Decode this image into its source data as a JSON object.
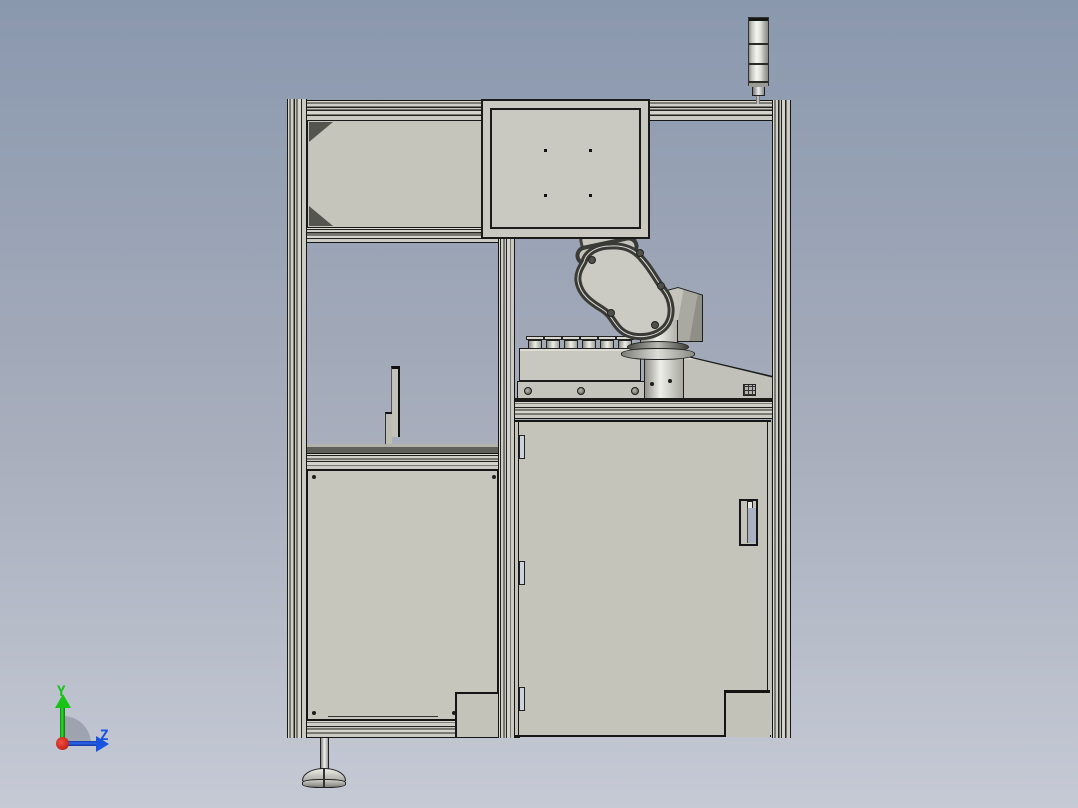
{
  "viewport": {
    "type": "3d-cad-viewport",
    "background_top": "#8a98ae",
    "background_bottom": "#c5cad5"
  },
  "triad": {
    "y_label": "Y",
    "z_label": "Z",
    "y_color": "#17c417",
    "z_color": "#1a53e0",
    "origin_color": "#d01812",
    "arc_color": "#9aa0ac"
  },
  "assembly": {
    "description": "robot work cell on aluminum extrusion frame",
    "palette": {
      "panel": "#c7c7bf",
      "cabinet": "#c4c4bb",
      "extrusion_light": "#d2d2ca",
      "extrusion_dark": "#23231f",
      "edge": "#161614",
      "metal_light": "#f2f2ee",
      "metal_dark": "#8e8e87",
      "handle_recess": "#a9b2c1",
      "hinge_fill": "#ccd3de",
      "table_edge": "#5f5f59"
    },
    "parts": [
      {
        "name": "signal-tower",
        "segments": 3
      },
      {
        "name": "top-enclosure-box",
        "screw_holes": 4
      },
      {
        "name": "frame-top-beam"
      },
      {
        "name": "frame-left-column"
      },
      {
        "name": "frame-middle-column"
      },
      {
        "name": "frame-right-column"
      },
      {
        "name": "upper-left-panel",
        "corner_gussets": 2
      },
      {
        "name": "left-mid-beam"
      },
      {
        "name": "sensor-bracket"
      },
      {
        "name": "left-work-table"
      },
      {
        "name": "left-lower-panel"
      },
      {
        "name": "frame-bottom-beam"
      },
      {
        "name": "robot-arm"
      },
      {
        "name": "robot-base-pedestal"
      },
      {
        "name": "nozzle-fixture",
        "nozzle_count": 6,
        "screw_count": 3
      },
      {
        "name": "robot-table-beam"
      },
      {
        "name": "cabinet-door",
        "hinge_count": 3
      },
      {
        "name": "door-handle"
      },
      {
        "name": "corner-kick-panels",
        "count": 2
      },
      {
        "name": "leveling-foot"
      }
    ]
  }
}
